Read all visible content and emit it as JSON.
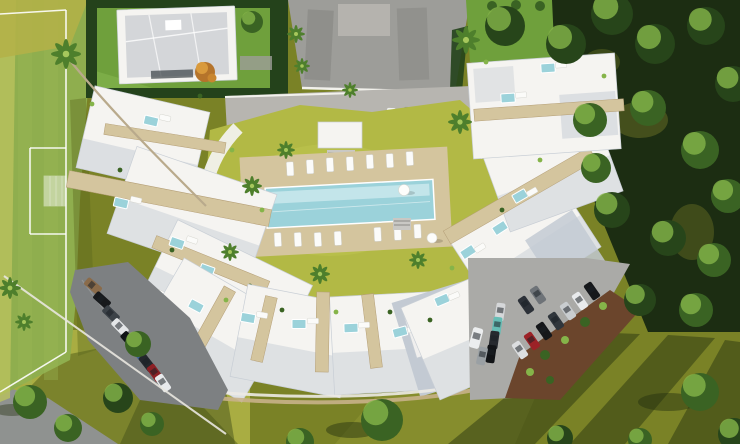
{
  "scene": {
    "kind": "aerial-3d-architectural-render",
    "description": "Bird's-eye render of a white crescent-shaped apartment complex with rooftop terraces and plunge pools around a communal lawn and rectangular swimming pool; football pitch on the left, detached villa at top, woodland on the right, three parking areas with cars.",
    "has_text": false
  },
  "inventory": {
    "apartment_wings": 4,
    "detached_villa": 1,
    "sports_field": "football pitch with white markings and one goal",
    "communal_pool": "long rectangular pool on beige deck",
    "rooftop_plunge_pools": 18,
    "poolside_sun_loungers": 17,
    "parking_lots": 3,
    "cars_total": 30,
    "palm_trees": 13,
    "shade_trees": 28
  },
  "pool": {
    "deck_loungers_top_row": 7,
    "deck_loungers_bottom_rows": 7,
    "deck_loungers_side": 3,
    "parasols": 2
  },
  "parking": {
    "top_road": {
      "cars": [
        "#e9eaec",
        "#17191c",
        "#41474d",
        "#f0f1f2",
        "#8e9398",
        "#e9ebed"
      ]
    },
    "bottom_left": {
      "cars": [
        "#8a6b4a",
        "#17191c",
        "#3c4248",
        "#e4e6e8",
        "#101316",
        "#3d6291",
        "#24282d",
        "#8d2025",
        "#e8eaec"
      ]
    },
    "bottom_right": {
      "cars": [
        "#16181b",
        "#e8eaec",
        "#c9cdd0",
        "#30363c",
        "#15171a",
        "#9c2227",
        "#dcdee0",
        "#d5d7d9",
        "#66bdb5",
        "#26292e",
        "#121417",
        "#6e7378",
        "#2c3138",
        "#eceeef",
        "#9aa0a4"
      ]
    }
  },
  "palette": {
    "grass_olive": "#7a8226",
    "grass_light": "#a9ad42",
    "field_green": "#8fae4e",
    "field_light": "#b9c25e",
    "lawn_villa": "#6fa03c",
    "lawn_court": "#b2b945",
    "hedge_dark": "#24421b",
    "forest_dark": "#1c2d12",
    "tree_mid": "#3a6323",
    "tree_darker": "#27451a",
    "tree_light": "#85b449",
    "palm_green": "#4e7f2c",
    "pavement": "#9d9d99",
    "road": "#b7b5b0",
    "building_white": "#f5f4f1",
    "building_shadow": "#c3cad3",
    "building_edge": "#c9cfd6",
    "roof_gray": "#d4d6d9",
    "deck_beige": "#d4c59e",
    "pool_water": "#9bd2da",
    "pool_light": "#cdeaee",
    "asphalt_dark": "#7d8082",
    "asphalt_light": "#aaaaa7",
    "soil": "#6b452c",
    "trunk": "#b9aa8c",
    "shadow_green": "#222f10",
    "curb_white": "#f2f1ec"
  }
}
